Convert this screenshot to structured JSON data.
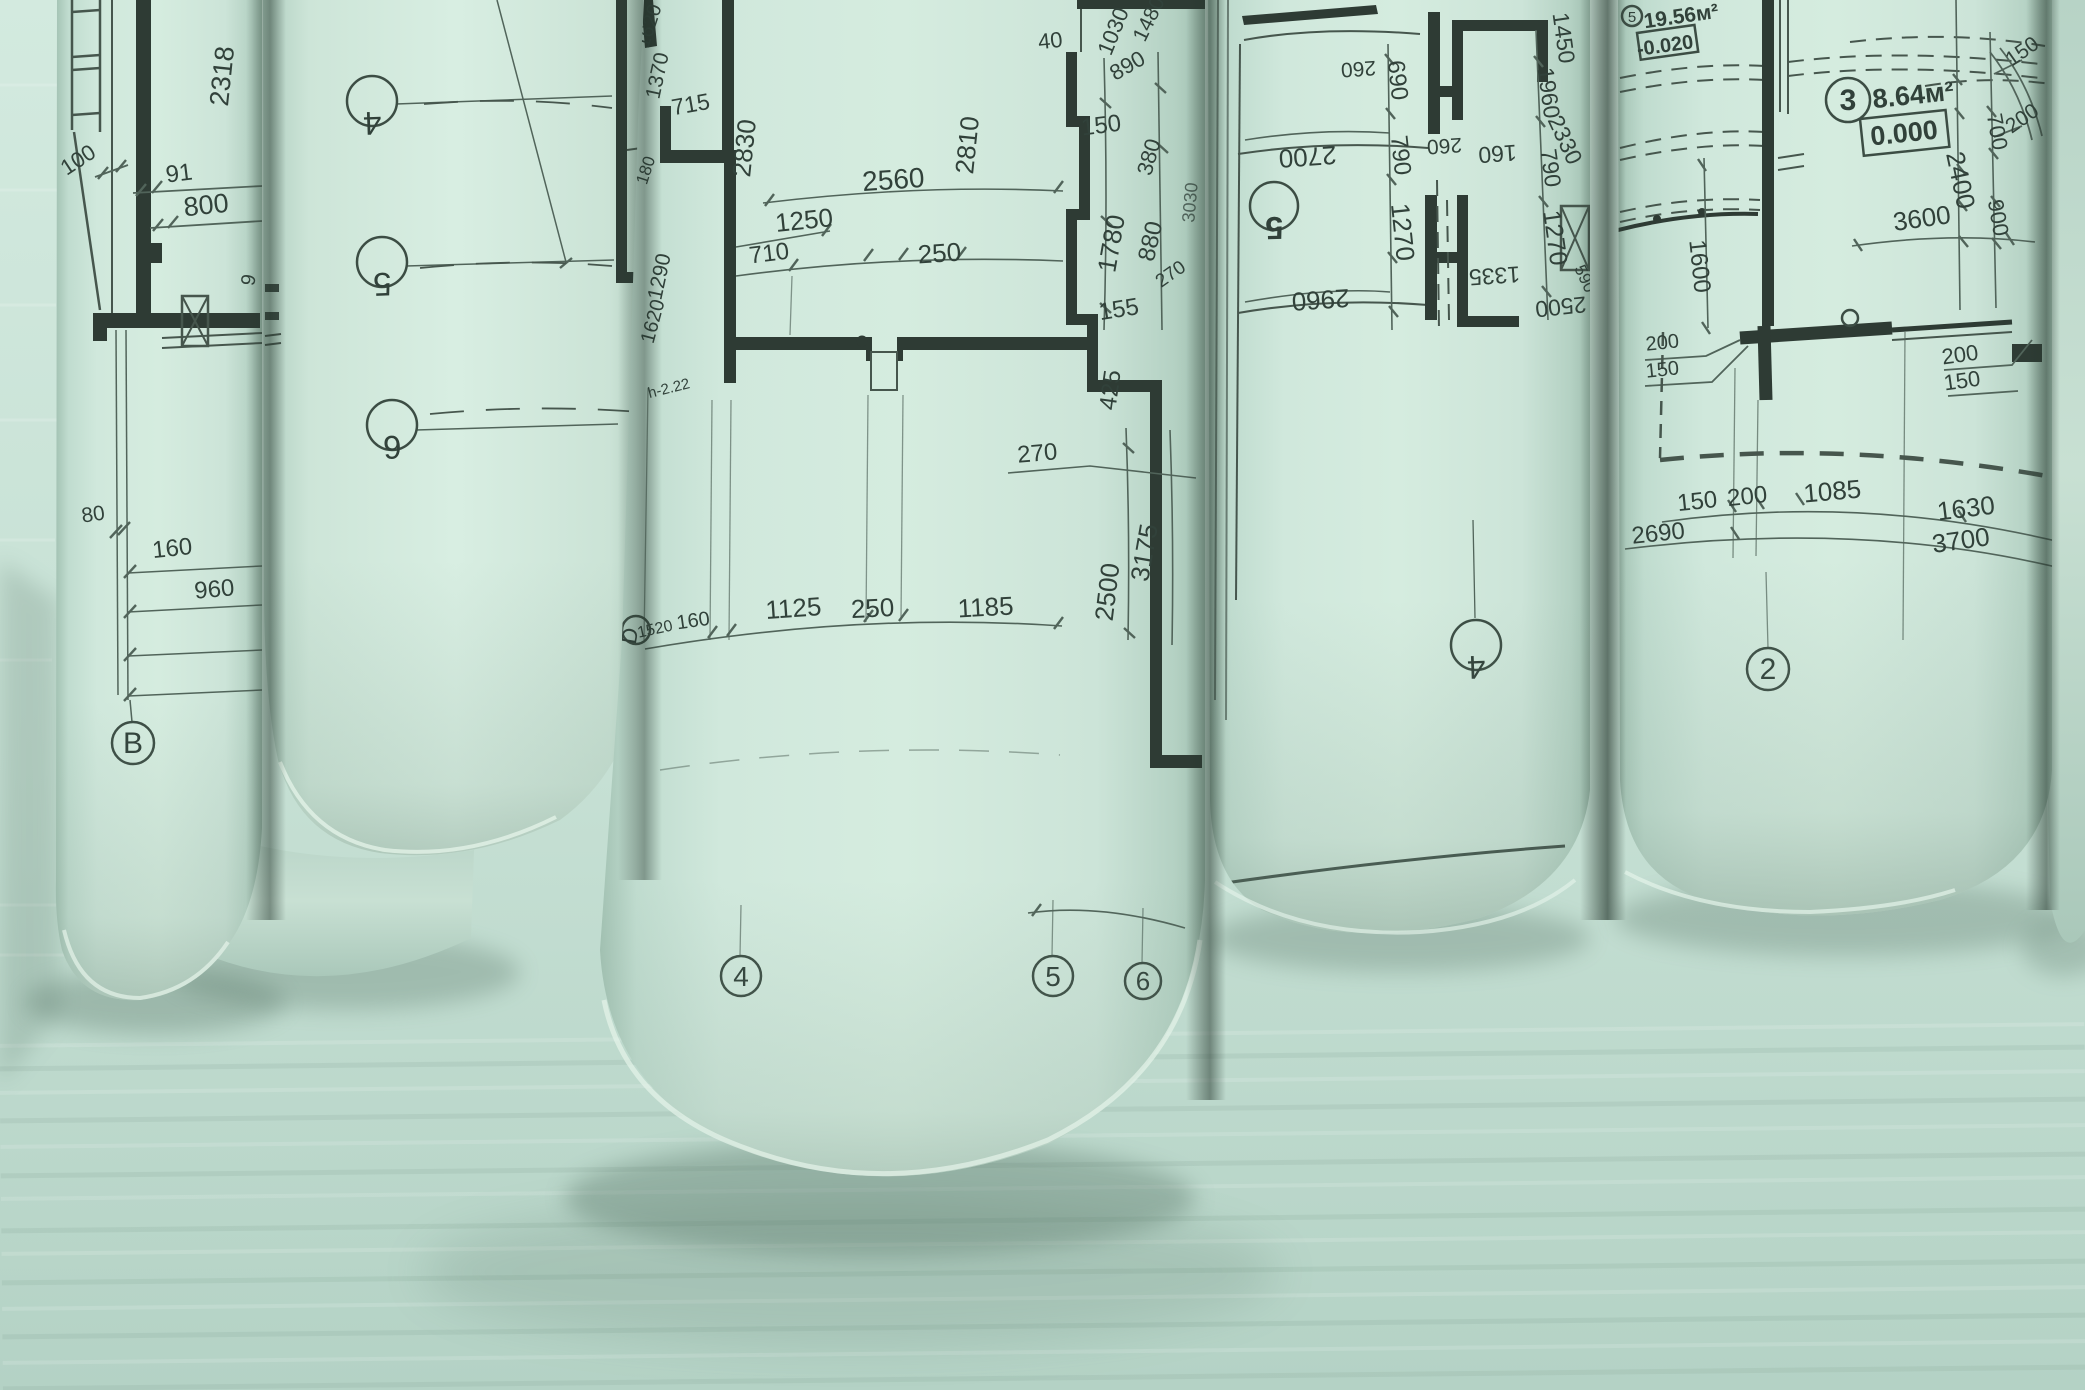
{
  "colors": {
    "background_top": "#d3eadf",
    "background_bottom": "#b9d6ca",
    "paper": "#cfe7db",
    "line": "#2e3b34",
    "shadow": "#57735f"
  },
  "roll1": {
    "dims": {
      "d100": "100",
      "d91": "91",
      "d800": "800",
      "d2318": "2318",
      "d9": "9",
      "d80": "80",
      "d160": "160",
      "d960": "960"
    },
    "axes": {
      "b": "B"
    }
  },
  "roll2": {
    "axes": {
      "a4": "4",
      "a5": "5",
      "a6": "6"
    }
  },
  "roll3": {
    "dims": {
      "d1620a": "1620",
      "d1370": "1370",
      "d715": "715",
      "d180": "180",
      "d2830": "2830",
      "d2560": "2560",
      "d2810": "2810",
      "d1250": "1250",
      "d710": "710",
      "d250a": "250",
      "d1290": "1290",
      "d1620b": "1620",
      "d40": "40",
      "d1030": "1030",
      "d1480": "1480",
      "d890": "890",
      "d150": "150",
      "d380": "380",
      "d1780": "1780",
      "d880": "880",
      "d155": "155",
      "d425": "425",
      "d270a": "270",
      "d270b": "270",
      "d2500": "2500",
      "d3175": "3175",
      "d1520": "1520",
      "d160b": "160",
      "d1125": "1125",
      "d250b": "250",
      "d1185": "1185",
      "d3030": "3030"
    },
    "note_h": "h-2.22",
    "axes": {
      "aD": "D",
      "a4": "4",
      "a5": "5",
      "a6": "6"
    }
  },
  "roll4": {
    "dims": {
      "d2700": "2700",
      "d2960": "2960",
      "d260a": "260",
      "d690": "690",
      "d790a": "790",
      "d260b": "260",
      "d1270a": "1270",
      "d1450": "1450",
      "d1960": "1960",
      "d2330": "2330",
      "d160": "160",
      "d790b": "790",
      "d1270b": "1270",
      "d1335": "1335",
      "d2500": "2500",
      "d590": "590"
    },
    "rooms": {
      "r5": "5"
    },
    "axes": {
      "a4": "4"
    }
  },
  "roll5": {
    "rooms": {
      "r5_num": "5",
      "r5_area": "19.56м²",
      "r5_level": "-0.020",
      "r3_num": "3",
      "r3_area": "8.64м²",
      "r3_level": "0.000"
    },
    "dims": {
      "d150a": "150",
      "d200a": "200",
      "d700": "700",
      "d2400": "2400",
      "d900": "900",
      "d3600": "3600",
      "d1600": "1600",
      "d200l": "200",
      "d150l": "150",
      "d200r": "200",
      "d150r": "150",
      "d150b": "150",
      "d200b": "200",
      "d1085": "1085",
      "d1630": "1630",
      "d2690": "2690",
      "d3700": "3700"
    },
    "axes": {
      "a2": "2"
    }
  }
}
